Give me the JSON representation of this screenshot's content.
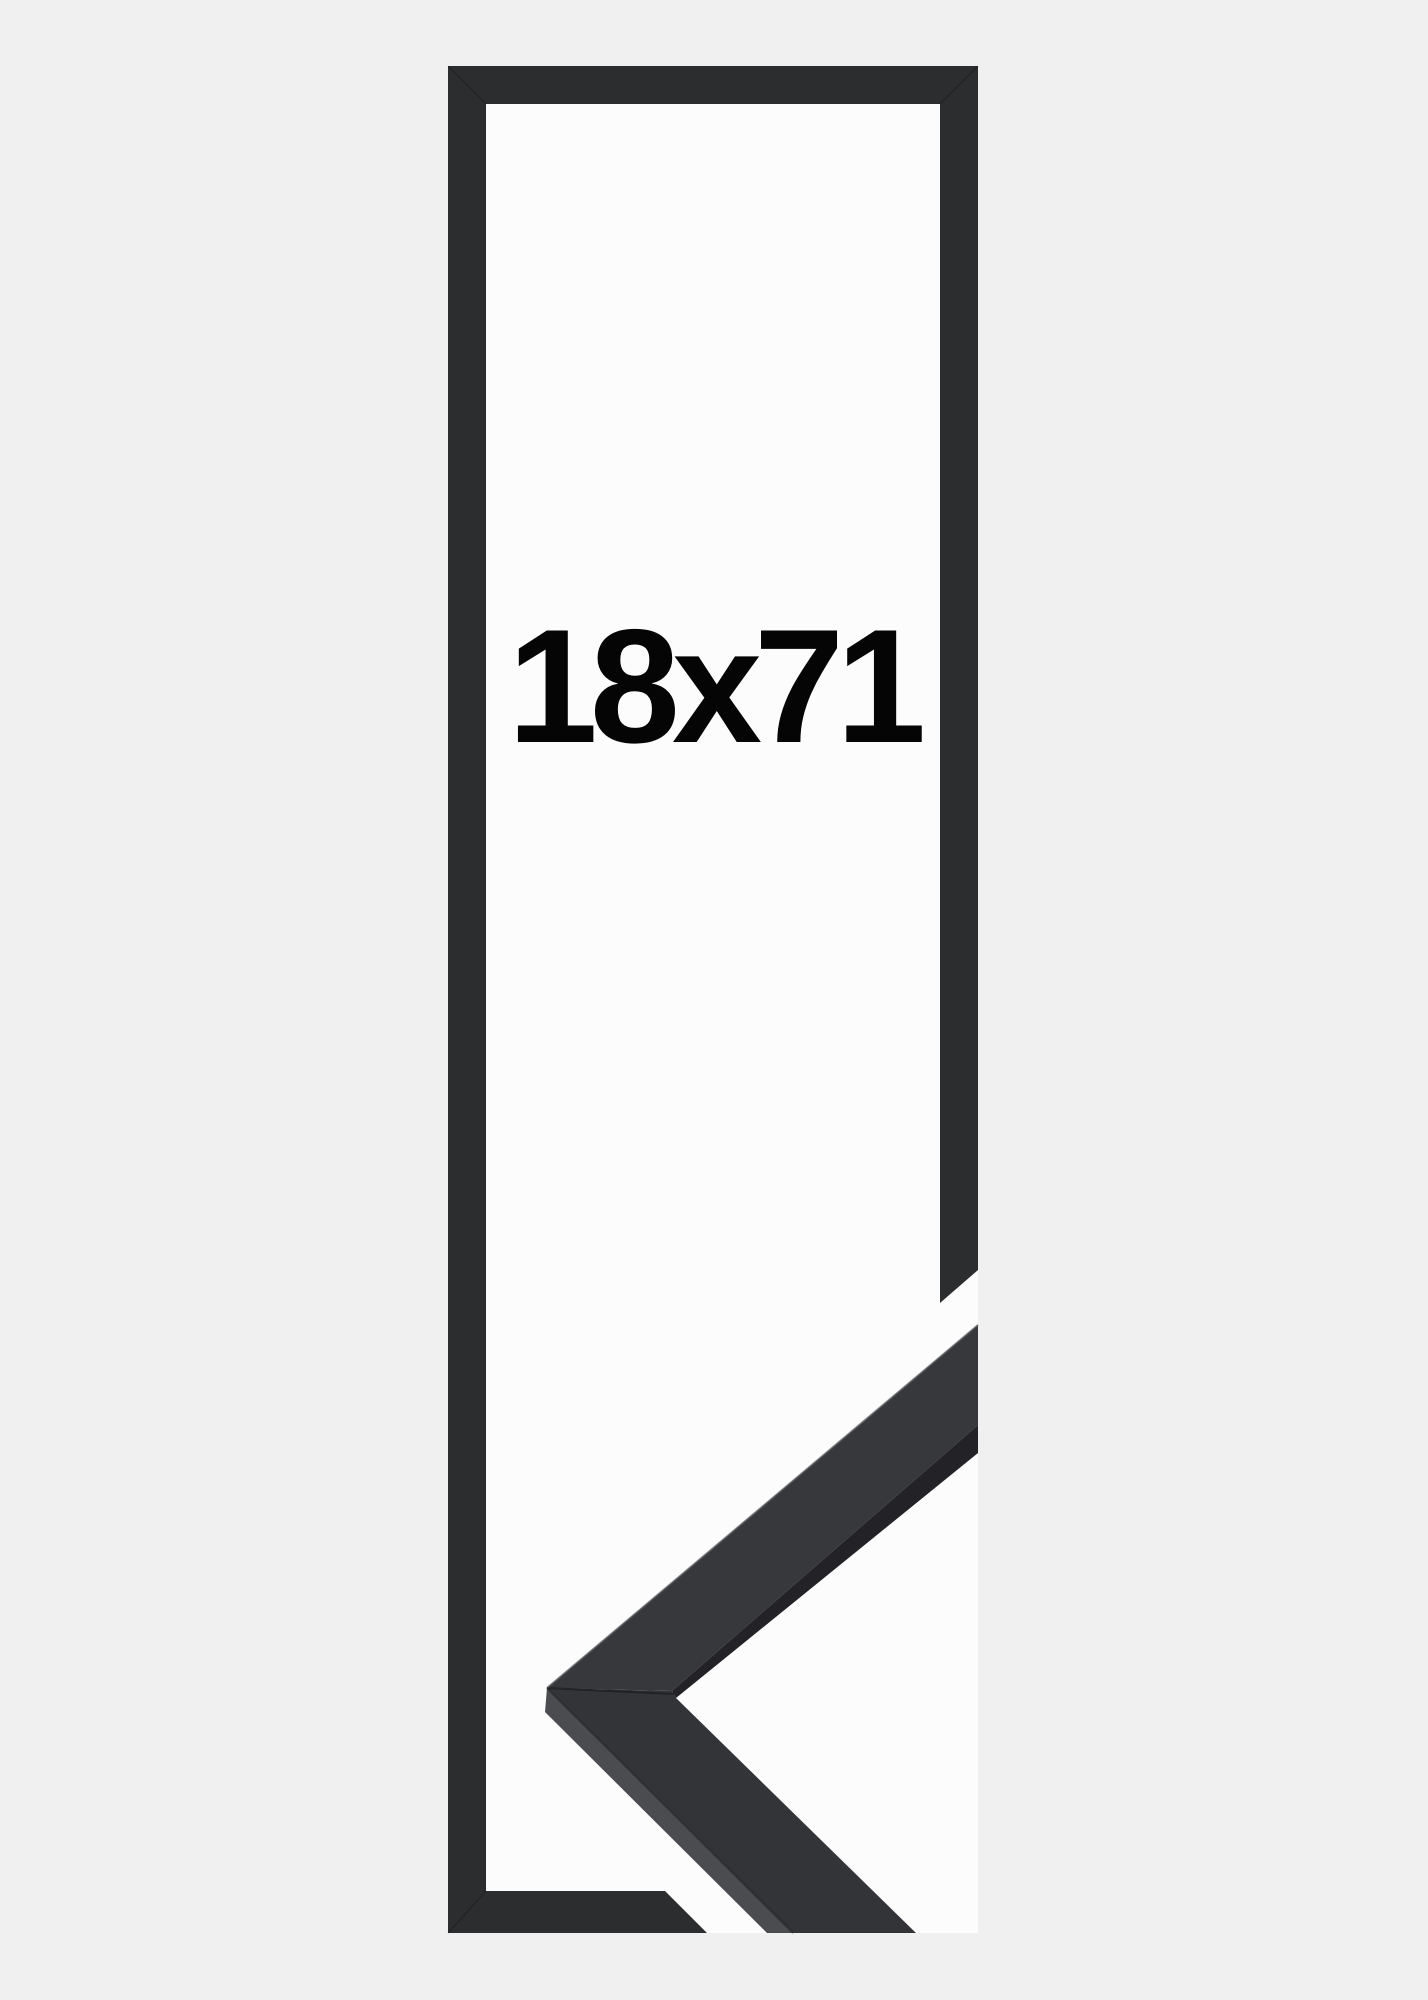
{
  "label": {
    "text": "18x71"
  },
  "colors": {
    "background": "#f0f0f1",
    "interior": "#fcfcfd",
    "frame": "#2c2d2f",
    "moulding_face": "#37383b",
    "moulding_face_lower": "#333438",
    "moulding_side": "#4b4c50",
    "moulding_edge": "#232327",
    "text": "#050505"
  }
}
